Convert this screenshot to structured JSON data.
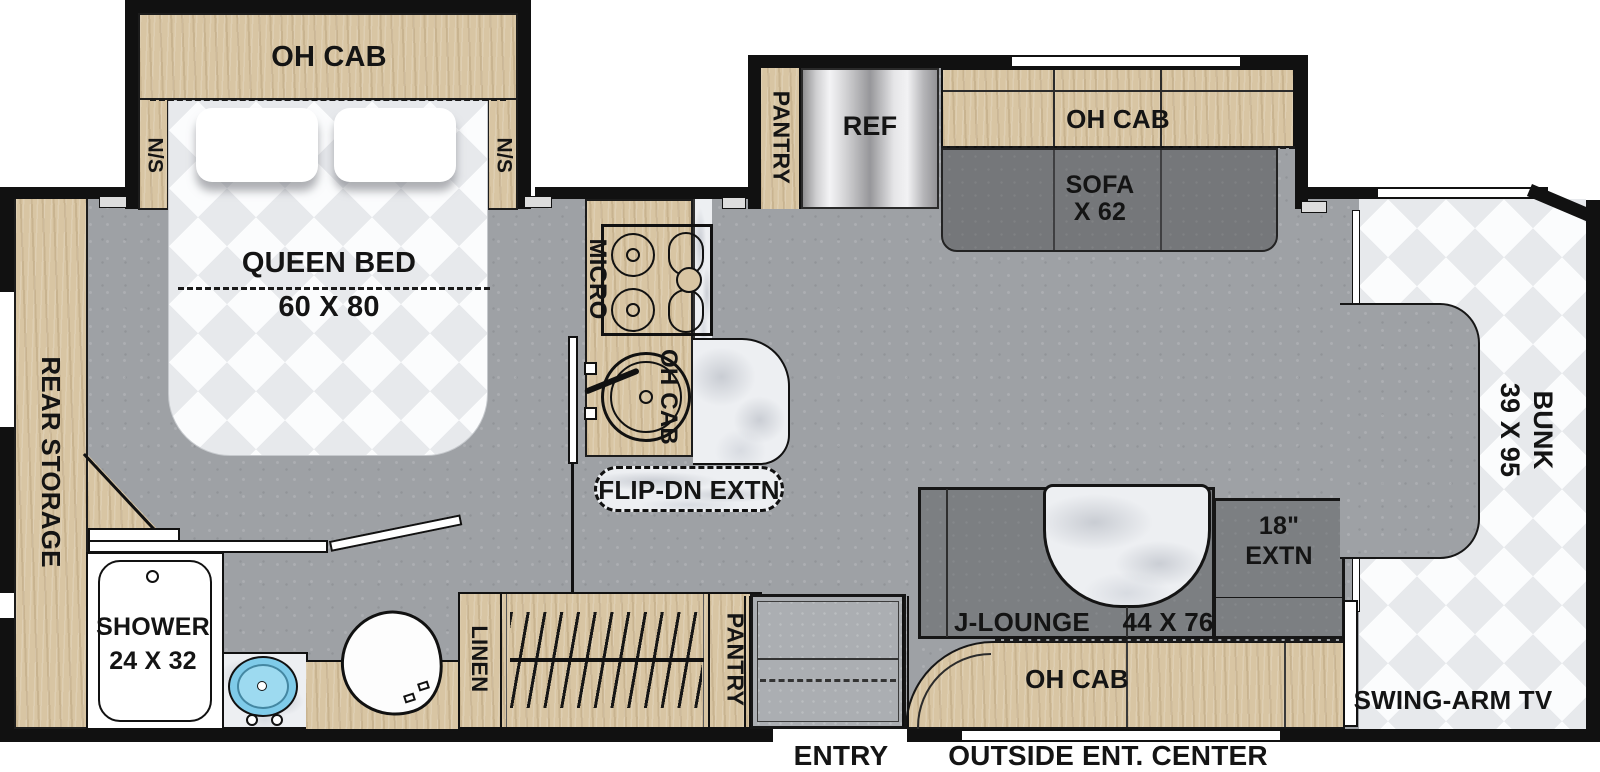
{
  "labels": {
    "bedroom": {
      "overhead_cabinet": "OH CAB",
      "nightstand_left": "N/S",
      "nightstand_right": "N/S",
      "bed": "QUEEN BED",
      "bed_size": "60 X 80"
    },
    "rear_storage": "REAR STORAGE",
    "kitchen": {
      "microwave": "MICRO",
      "overhead_cabinet": "OH CAB",
      "flip_down_extension": "FLIP-DN EXTN"
    },
    "galley_slideout": {
      "pantry": "PANTRY",
      "refrigerator": "REF",
      "overhead_cabinet": "OH CAB",
      "sofa": "SOFA",
      "sofa_size": "X 62"
    },
    "bathroom": {
      "shower": "SHOWER",
      "shower_size": "24 X 32"
    },
    "wardrobe": {
      "linen": "LINEN",
      "pantry": "PANTRY"
    },
    "lounge": {
      "name": "J-LOUNGE",
      "size": "44 X 76",
      "extension_size": "18\"",
      "extension": "EXTN",
      "overhead_cabinet": "OH CAB"
    },
    "cabover": {
      "bunk": "BUNK",
      "bunk_size": "39 X 95",
      "tv": "SWING-ARM TV"
    },
    "exterior": {
      "entry": "ENTRY",
      "outside_entertainment": "OUTSIDE ENT. CENTER"
    }
  },
  "colors": {
    "wall": "#111111",
    "floor": "#9ea1a5",
    "wood": "#d8c5a3",
    "sofa_gray": "#7c7f82",
    "marble": "#edeff2",
    "mattress": "#f6f7f8",
    "sink_blue": "#7fcbe9",
    "refrigerator_metal": "#c9c9cb",
    "entry_steps": "#abaeb2"
  }
}
